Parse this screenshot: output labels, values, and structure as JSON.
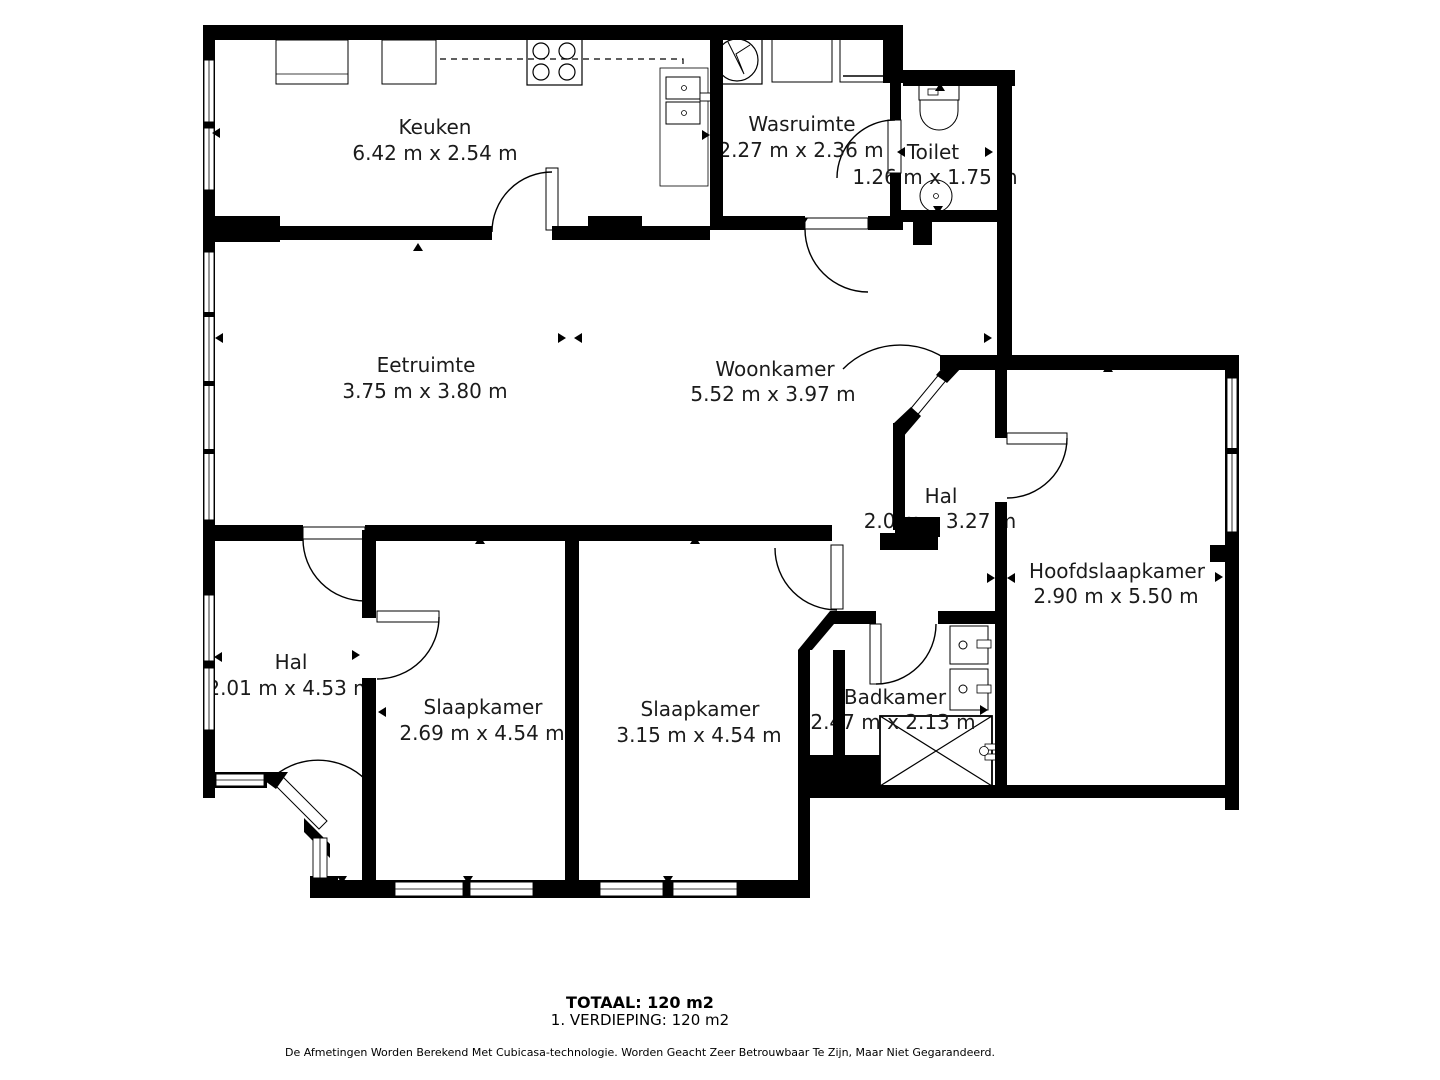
{
  "rooms": [
    {
      "name": "Keuken",
      "dims": "6.42 m x 2.54 m"
    },
    {
      "name": "Wasruimte",
      "dims": "2.27 m x 2.36 m"
    },
    {
      "name": "Toilet",
      "dims": "1.26 m x 1.75 m"
    },
    {
      "name": "Eetruimte",
      "dims": "3.75 m x 3.80 m"
    },
    {
      "name": "Woonkamer",
      "dims": "5.52 m x 3.97 m"
    },
    {
      "name": "Hal",
      "dims": "2.0 m x 3.27 m"
    },
    {
      "name": "Hoofdslaapkamer",
      "dims": "2.90 m x 5.50 m"
    },
    {
      "name": "Hal",
      "dims": "2.01 m x 4.53 m"
    },
    {
      "name": "Slaapkamer",
      "dims": "2.69 m x 4.54 m"
    },
    {
      "name": "Slaapkamer",
      "dims": "3.15 m x 4.54 m"
    },
    {
      "name": "Badkamer",
      "dims": "2.47 m x 2.13 m"
    }
  ],
  "footer": {
    "total": "TOTAAL: 120 m2",
    "floor": "1. VERDIEPING: 120 m2",
    "disclaimer": "De Afmetingen Worden Berekend Met Cubicasa-technologie. Worden Geacht Zeer Betrouwbaar Te Zijn, Maar Niet Gegarandeerd."
  },
  "icons": [
    "stove-icon",
    "kitchen-sink-icon",
    "kitchen-cabinets-icon",
    "washing-machine-icon",
    "appliance-icon",
    "toilet-icon",
    "toilet-sink-icon",
    "bathroom-sink-icon",
    "shower-icon",
    "door-arc",
    "window",
    "measure-arrow"
  ],
  "colors": {
    "wall": "#000000",
    "floor": "#ffffff",
    "text": "#1b1b1b"
  }
}
